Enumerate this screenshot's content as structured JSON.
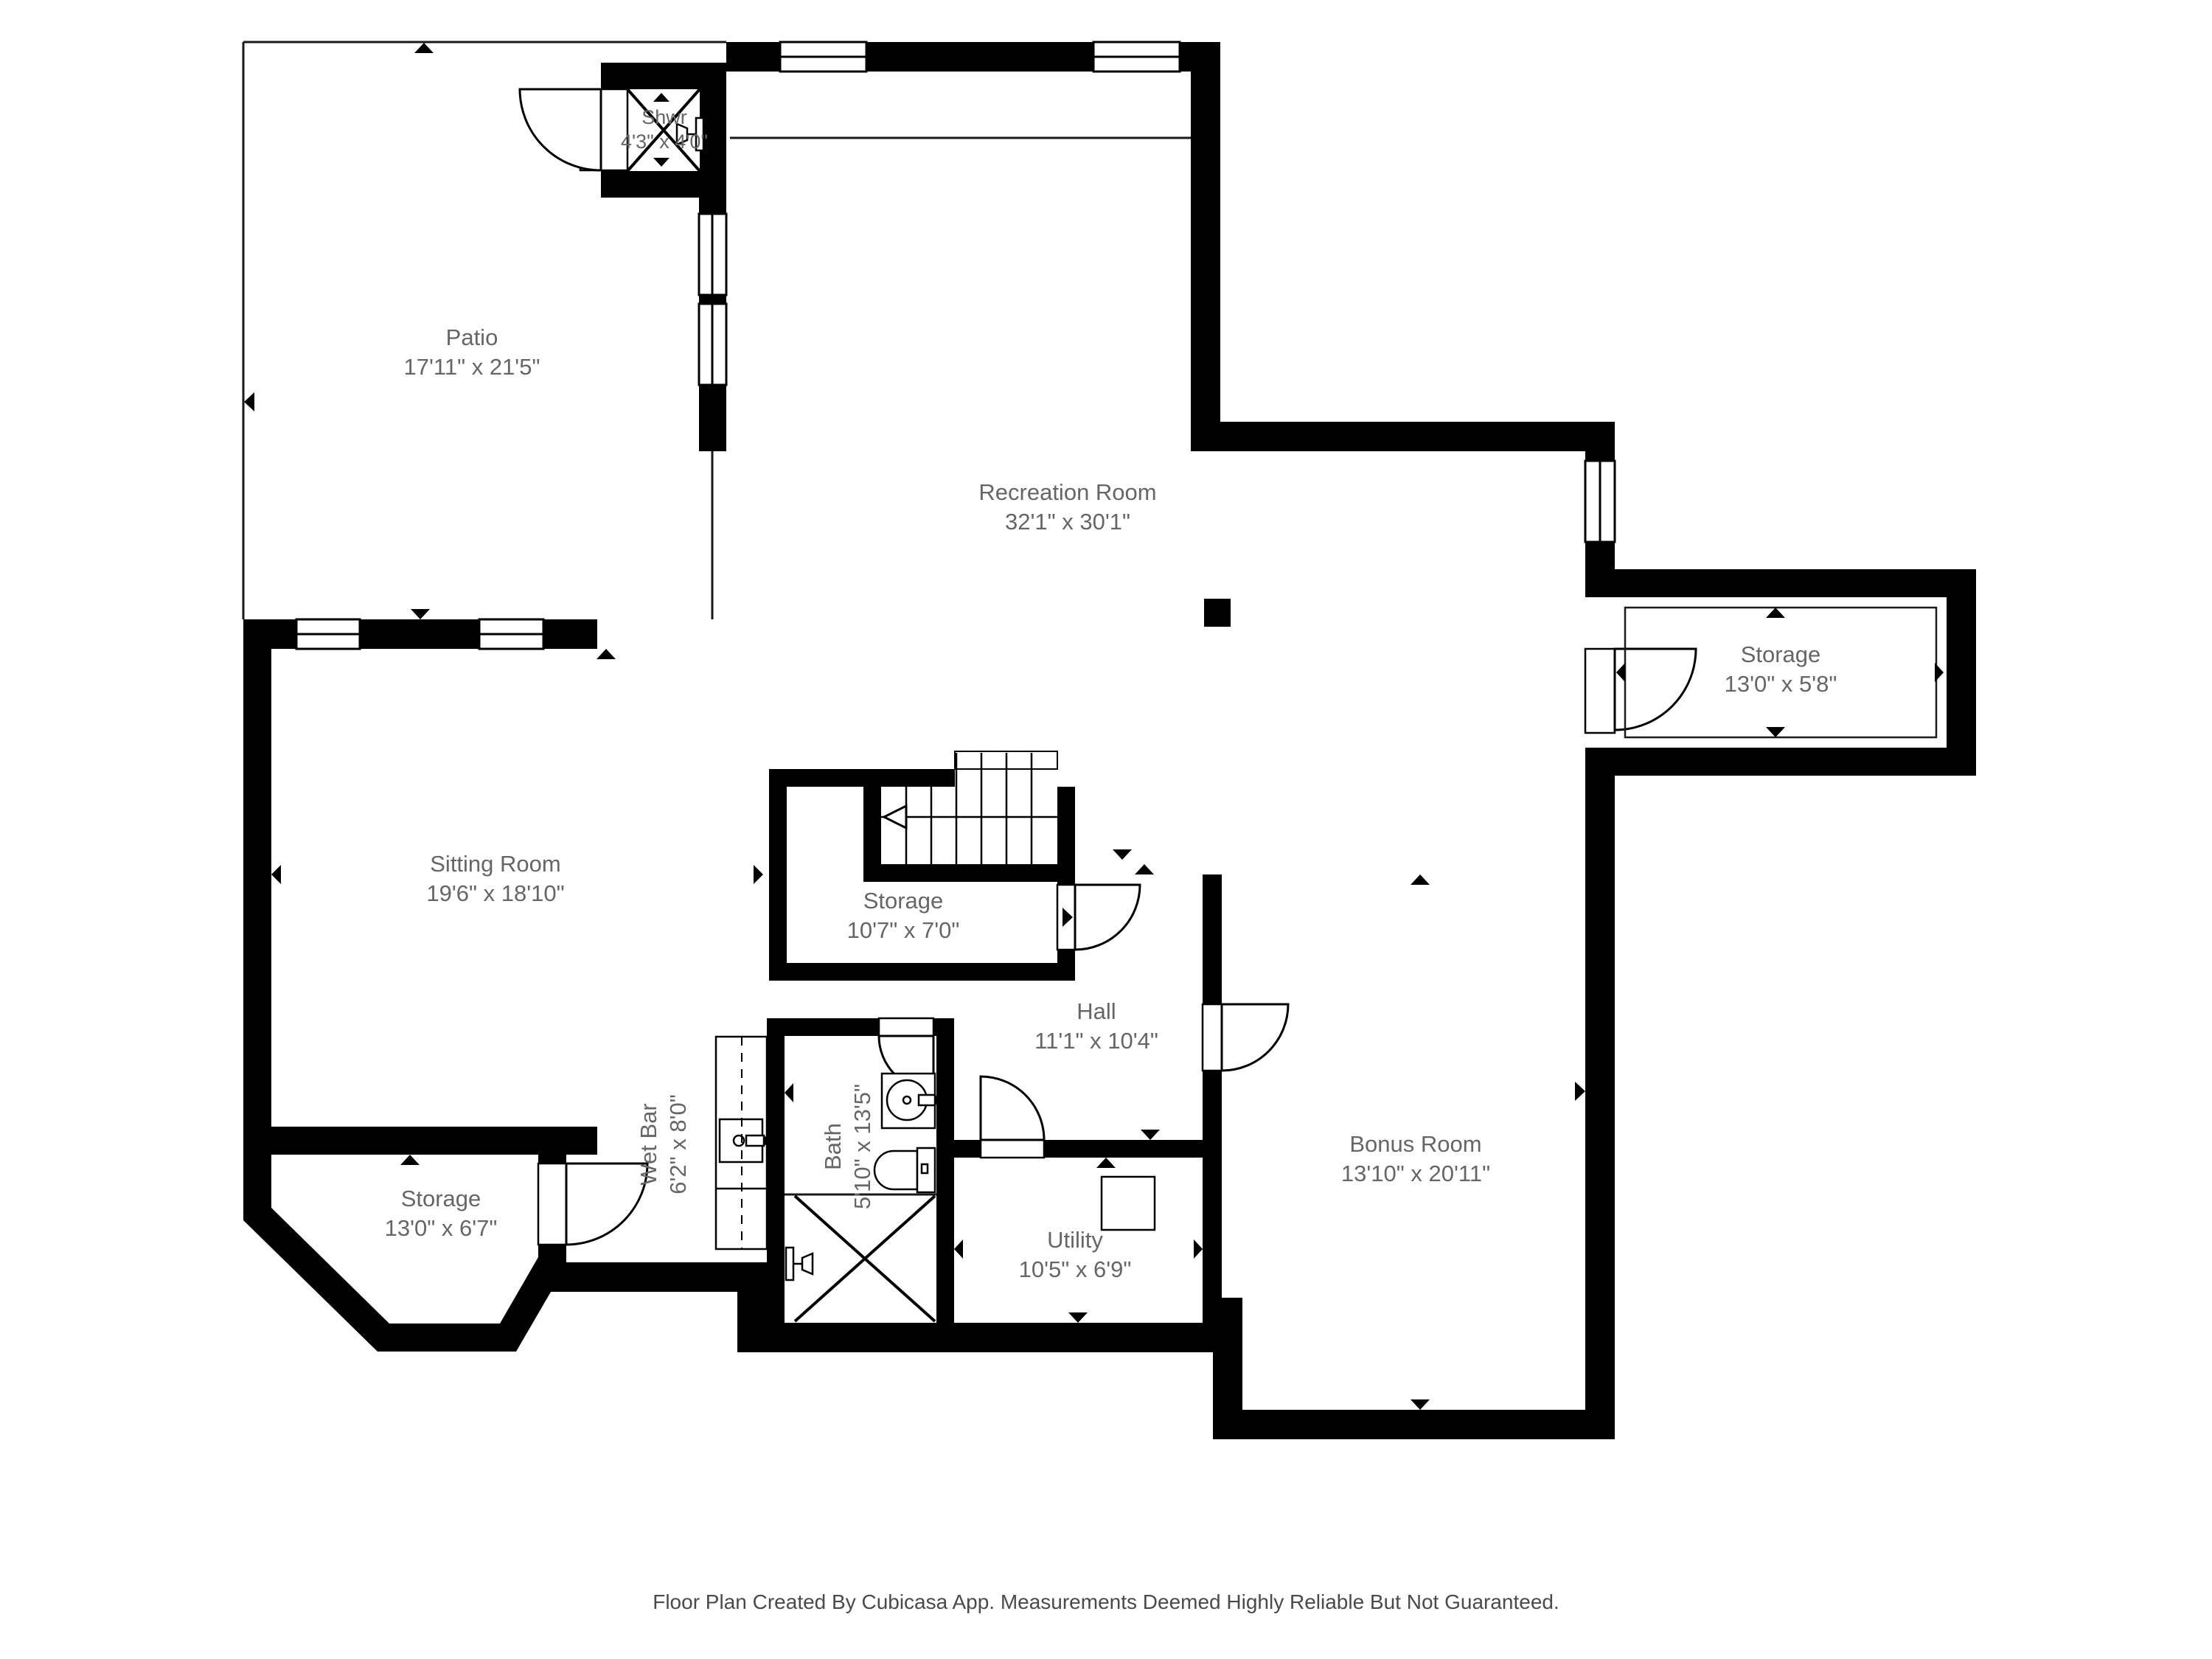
{
  "colors": {
    "wall": "#000000",
    "label_text": "#666666",
    "footer_text": "#4a4a4a",
    "floor": "#ffffff"
  },
  "rooms": {
    "patio": {
      "name": "Patio",
      "dims": "17'11\" x 21'5\""
    },
    "shower": {
      "name": "Shwr",
      "dims": "4'3\" x 4'0\""
    },
    "recreation": {
      "name": "Recreation Room",
      "dims": "32'1\" x 30'1\""
    },
    "storage_right": {
      "name": "Storage",
      "dims": "13'0\" x 5'8\""
    },
    "sitting": {
      "name": "Sitting Room",
      "dims": "19'6\" x 18'10\""
    },
    "storage_mid": {
      "name": "Storage",
      "dims": "10'7\" x 7'0\""
    },
    "hall": {
      "name": "Hall",
      "dims": "11'1\" x 10'4\""
    },
    "bath": {
      "name": "Bath",
      "dims": "5'10\" x 13'5\""
    },
    "wet_bar": {
      "name": "Wet Bar",
      "dims": "6'2\" x 8'0\""
    },
    "utility": {
      "name": "Utility",
      "dims": "10'5\" x 6'9\""
    },
    "bonus": {
      "name": "Bonus Room",
      "dims": "13'10\" x 20'11\""
    },
    "storage_left": {
      "name": "Storage",
      "dims": "13'0\" x 6'7\""
    }
  },
  "footer": {
    "disclaimer": "Floor Plan Created By Cubicasa App. Measurements Deemed Highly Reliable But Not Guaranteed."
  }
}
